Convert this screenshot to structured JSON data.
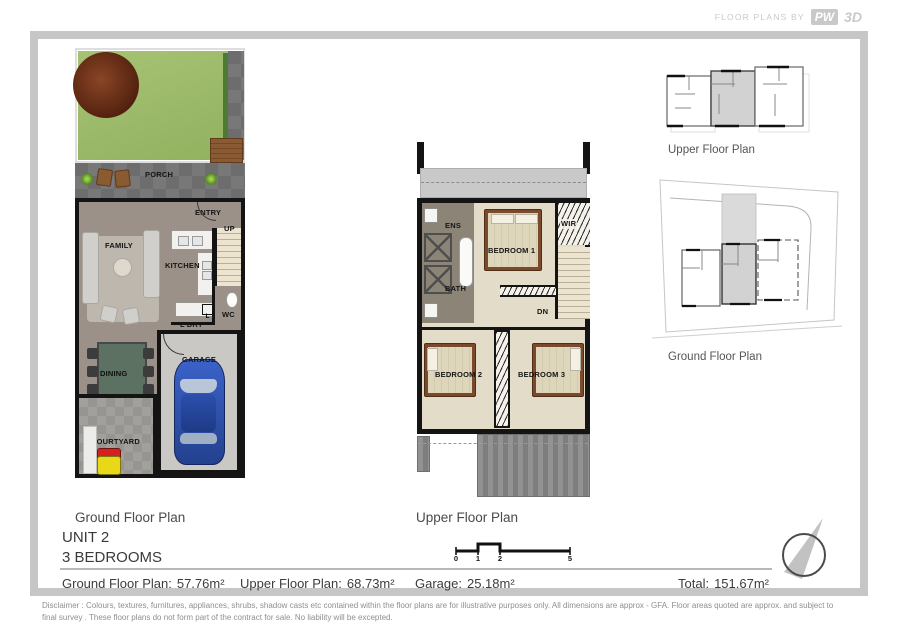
{
  "header": {
    "brand_prefix": "FLOOR PLANS BY",
    "brand_pw": "PW",
    "brand_3d": "3D"
  },
  "ground_floor": {
    "caption": "Ground Floor Plan",
    "rooms": {
      "porch": "PORCH",
      "entry": "ENTRY",
      "family": "FAMILY",
      "kitchen": "KITCHEN",
      "up": "UP",
      "laundry": "L'DRY",
      "laundry_unit": "L",
      "wc": "WC",
      "garage": "GARAGE",
      "dining": "DINING",
      "courtyard": "COURTYARD"
    }
  },
  "upper_floor": {
    "caption": "Upper Floor Plan",
    "rooms": {
      "ens": "ENS",
      "bath": "BATH",
      "bedroom1": "BEDROOM 1",
      "wir": "WIR",
      "down": "DN",
      "bedroom2": "BEDROOM 2",
      "bedroom3": "BEDROOM 3"
    }
  },
  "locators": {
    "upper_caption": "Upper Floor Plan",
    "ground_caption": "Ground Floor Plan"
  },
  "unit": {
    "name": "UNIT 2",
    "bedrooms": "3 BEDROOMS"
  },
  "scale_bar": {
    "ticks": [
      "0",
      "1",
      "2",
      "5"
    ]
  },
  "areas": [
    {
      "label": "Ground Floor Plan:",
      "value": "57.76m²"
    },
    {
      "label": "Upper Floor Plan:",
      "value": "68.73m²"
    },
    {
      "label": "Garage:",
      "value": "25.18m²"
    },
    {
      "label": "Total:",
      "value": "151.67m²"
    }
  ],
  "disclaimer": {
    "line1": "Disclaimer : Colours, textures, furnitures, appliances, shrubs, shadow casts etc contained within the floor plans  are for illustrative purposes only. All dimensions are approx - GFA. Floor areas quoted are approx. and subject to",
    "line2": "final survey . These floor plans do not form part of the contract for sale. No liability will be excepted."
  },
  "colors": {
    "frame": "#c6c6c6",
    "wall": "#141414",
    "lawn": "#9cbd6d",
    "floor_ground": "#9b9189",
    "floor_upper": "#e3dcc8",
    "roof": "#8a8a8a",
    "car": "#2a50b5",
    "bin_red": "#d42020",
    "bin_yellow": "#e8d818"
  }
}
